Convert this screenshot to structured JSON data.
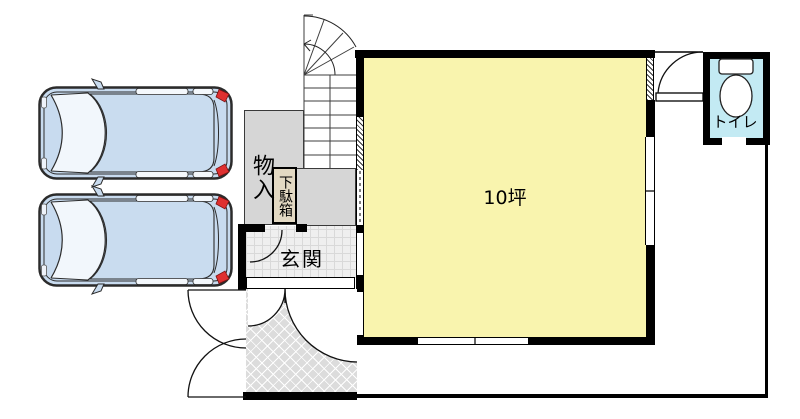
{
  "title": "floor-plan-1f",
  "labels": {
    "storage": "物入",
    "shoe_box": "下駄箱",
    "entrance_hall": "玄関",
    "main_room": "10坪",
    "toilet": "トイレ"
  },
  "colors": {
    "room_fill": "#F9F4AE",
    "gray_area": "#D6D6D6",
    "toilet_fill": "#C3EAF3",
    "shoe_box_fill": "#E3D9C3",
    "car_body": "#C8DBEF",
    "taillight_red": "#DF3030",
    "wall": "#000000"
  }
}
